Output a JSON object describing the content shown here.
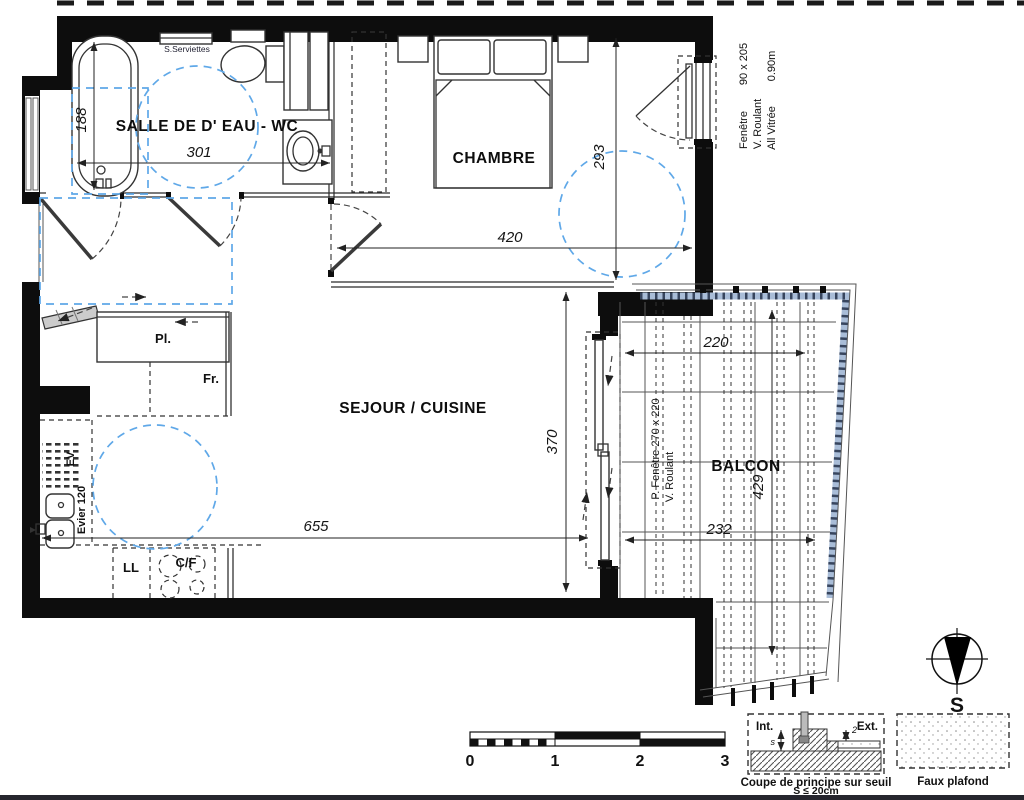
{
  "colors": {
    "accent_blue": "#5fa8e8",
    "railing_blue": "#a9bdd8",
    "wall_black": "#0d0d0d"
  },
  "rooms": {
    "bathroom": "SALLE DE D' EAU - WC",
    "bedroom": "CHAMBRE",
    "living": "SEJOUR / CUISINE",
    "balcony": "BALCON"
  },
  "fixtures": {
    "towels": "S.Serviettes",
    "closet": "Pl.",
    "fridge": "Fr.",
    "sink_code": "EV",
    "sink_label": "Evier 120",
    "washer": "LL",
    "cooktop": "C/F"
  },
  "dimensions": {
    "bath_width": "188",
    "bath_length": "301",
    "bedroom_width": "420",
    "bedroom_depth": "293",
    "living_width": "655",
    "living_depth": "370",
    "balcony_top": "220",
    "balcony_bottom": "232",
    "balcony_length": "429"
  },
  "window_note": {
    "name": "Fenêtre",
    "size": "90 x 205",
    "shutter": "V. Roulant",
    "glazing": "All Vitrée",
    "sill": "0.90m"
  },
  "balcony_door_note": {
    "line1": "P. Fenêtre  270 x 220",
    "line2": "V. Roulant"
  },
  "scale_bar": {
    "ticks": [
      "0",
      "1",
      "2",
      "3"
    ]
  },
  "threshold_detail": {
    "interior": "Int.",
    "exterior": "Ext.",
    "s_label": "s",
    "step_label": "2",
    "caption_line1": "Coupe de principe sur seuil",
    "caption_line2": "S ≤ 20cm"
  },
  "ceiling_legend": {
    "caption": "Faux plafond"
  },
  "compass": {
    "south": "S"
  }
}
